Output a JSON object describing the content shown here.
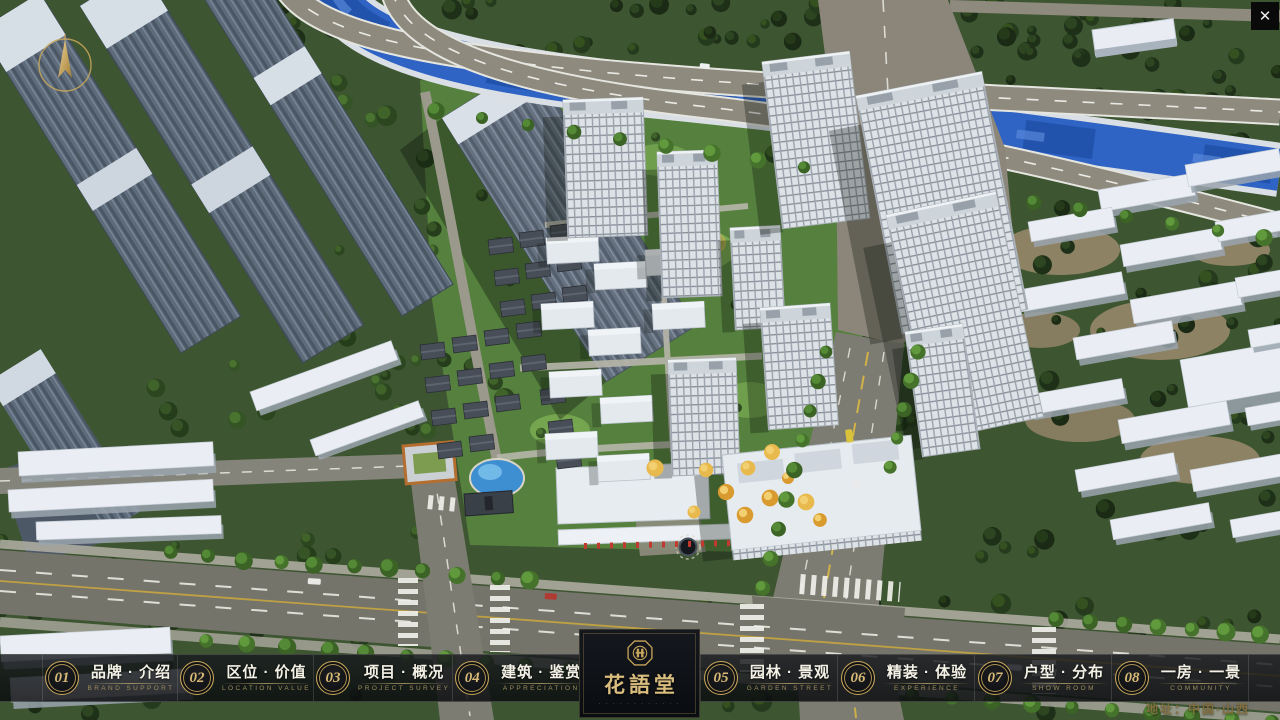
{
  "ui": {
    "close_label": "✕",
    "address": "地址：中国·山西",
    "logo": {
      "title": "花語堂",
      "microtext": "· · · · · · · · · · · ·"
    },
    "nav_items": [
      {
        "num": "01",
        "title": "品牌 · 介绍",
        "subtitle": "BRAND SUPPORT"
      },
      {
        "num": "02",
        "title": "区位 · 价值",
        "subtitle": "LOCATION VALUE"
      },
      {
        "num": "03",
        "title": "项目 · 概况",
        "subtitle": "PROJECT SURVEY"
      },
      {
        "num": "04",
        "title": "建筑 · 鉴赏",
        "subtitle": "APPRECIATION"
      },
      {
        "num": "05",
        "title": "园林 · 景观",
        "subtitle": "GARDEN STREET"
      },
      {
        "num": "06",
        "title": "精装 · 体验",
        "subtitle": "EXPERIENCE"
      },
      {
        "num": "07",
        "title": "户型 · 分布",
        "subtitle": "SHOW ROOM"
      },
      {
        "num": "08",
        "title": "一房 · 一景",
        "subtitle": "COMMUNITY"
      }
    ]
  },
  "colors": {
    "accent_gold": "#c9a85c",
    "nav_bar_bg": "#101318",
    "nav_text": "#f4f1e6",
    "nav_subtitle_gold": "#9d8c5c",
    "address_gold": "#83703f",
    "river_blue": "#2f63c4",
    "close_button_bg": "#0a0a0a"
  }
}
